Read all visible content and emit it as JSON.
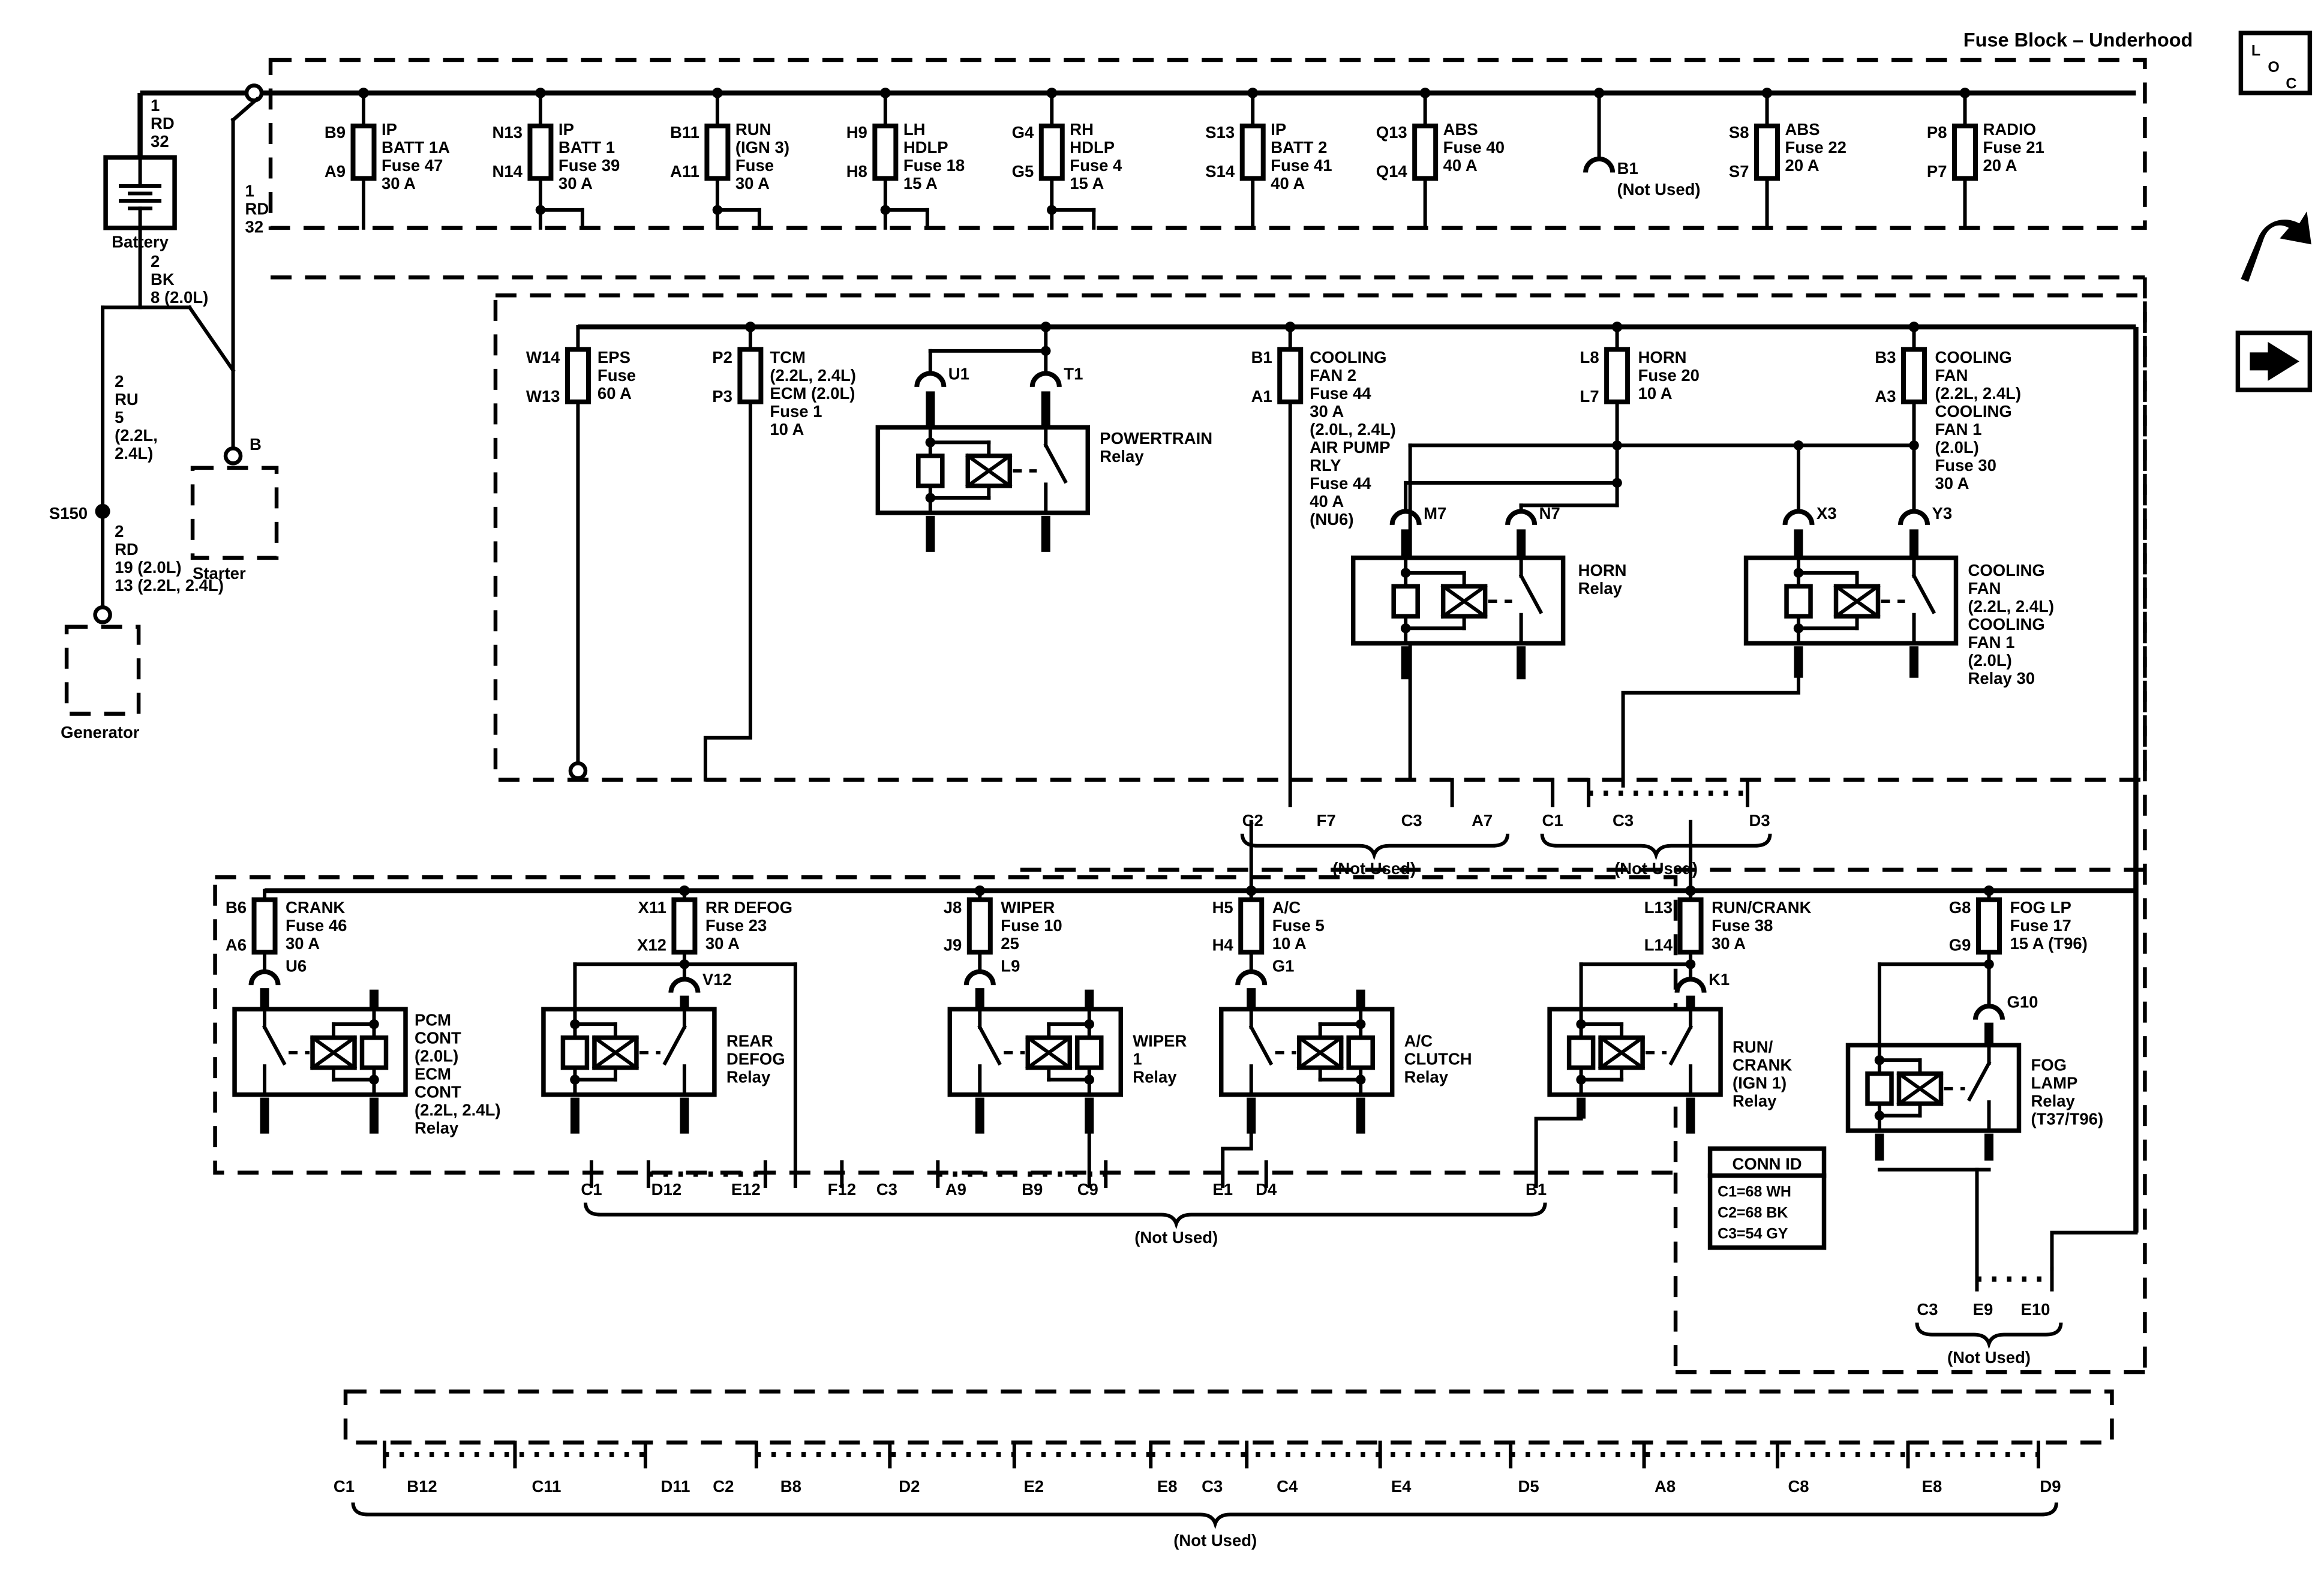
{
  "title": "Fuse Block – Underhood",
  "corner": {
    "loc": [
      "L",
      "O",
      "C"
    ]
  },
  "left": {
    "wire_battery_top": [
      "1",
      "RD",
      "32"
    ],
    "battery": "Battery",
    "wire_starter": [
      "1",
      "RD",
      "32"
    ],
    "terminal_b": "B",
    "starter": "Starter",
    "wire_battery_neg": [
      "2",
      "BK",
      "8 (2.0L)"
    ],
    "wire_ru": [
      "2",
      "RU",
      "5",
      "(2.2L,",
      "2.4L)"
    ],
    "splice": "S150",
    "wire_rd2": [
      "2",
      "RD",
      "19 (2.0L)",
      "13 (2.2L, 2.4L)"
    ],
    "generator": "Generator"
  },
  "row1": {
    "fuses": [
      {
        "pt": "B9",
        "pb": "A9",
        "d": [
          "IP",
          "BATT 1A",
          "Fuse 47",
          "30 A"
        ]
      },
      {
        "pt": "N13",
        "pb": "N14",
        "d": [
          "IP",
          "BATT 1",
          "Fuse 39",
          "30 A"
        ]
      },
      {
        "pt": "B11",
        "pb": "A11",
        "d": [
          "RUN",
          "(IGN 3)",
          "Fuse",
          "30 A"
        ]
      },
      {
        "pt": "H9",
        "pb": "H8",
        "d": [
          "LH",
          "HDLP",
          "Fuse 18",
          "15 A"
        ]
      },
      {
        "pt": "G4",
        "pb": "G5",
        "d": [
          "RH",
          "HDLP",
          "Fuse 4",
          "15 A"
        ]
      },
      {
        "pt": "S13",
        "pb": "S14",
        "d": [
          "IP",
          "BATT 2",
          "Fuse 41",
          "40 A"
        ]
      },
      {
        "pt": "Q13",
        "pb": "Q14",
        "d": [
          "ABS",
          "Fuse 40",
          "40 A"
        ]
      },
      {
        "pt": "S8",
        "pb": "S7",
        "d": [
          "ABS",
          "Fuse 22",
          "20 A"
        ]
      },
      {
        "pt": "P8",
        "pb": "P7",
        "d": [
          "RADIO",
          "Fuse 21",
          "20 A"
        ]
      }
    ],
    "stub": {
      "pin": "B1",
      "note": "(Not Used)"
    }
  },
  "row2": {
    "fuses": [
      {
        "pt": "W14",
        "pb": "W13",
        "d": [
          "EPS",
          "Fuse",
          "60 A"
        ]
      },
      {
        "pt": "P2",
        "pb": "P3",
        "d": [
          "TCM",
          "(2.2L, 2.4L)",
          "ECM (2.0L)",
          "Fuse 1",
          "10 A"
        ]
      },
      {
        "pt": "B1",
        "pb": "A1",
        "d": [
          "COOLING",
          "FAN 2",
          "Fuse 44",
          "30 A",
          "(2.0L, 2.4L)",
          "AIR PUMP",
          "RLY",
          "Fuse 44",
          "40 A",
          "(NU6)"
        ]
      },
      {
        "pt": "L8",
        "pb": "L7",
        "d": [
          "HORN",
          "Fuse 20",
          "10 A"
        ]
      },
      {
        "pt": "B3",
        "pb": "A3",
        "d": [
          "COOLING",
          "FAN",
          "(2.2L, 2.4L)",
          "COOLING",
          "FAN 1",
          "(2.0L)",
          "Fuse 30",
          "30 A"
        ]
      }
    ],
    "relays": [
      {
        "pa": "U1",
        "pb": "T1",
        "label": [
          "POWERTRAIN",
          "Relay"
        ]
      },
      {
        "pa": "M7",
        "pb": "N7",
        "label": [
          "HORN",
          "Relay"
        ]
      },
      {
        "pa": "X3",
        "pb": "Y3",
        "label": [
          "COOLING",
          "FAN",
          "(2.2L, 2.4L)",
          "COOLING",
          "FAN 1",
          "(2.0L)",
          "Relay 30"
        ]
      }
    ]
  },
  "row3": {
    "fuses": [
      {
        "pt": "B6",
        "pb": "A6",
        "d": [
          "CRANK",
          "Fuse 46",
          "30 A"
        ],
        "pin": "U6"
      },
      {
        "pt": "X11",
        "pb": "X12",
        "d": [
          "RR DEFOG",
          "Fuse 23",
          "30 A"
        ],
        "pin": "V12"
      },
      {
        "pt": "J8",
        "pb": "J9",
        "d": [
          "WIPER",
          "Fuse 10",
          "25"
        ],
        "pin": "L9"
      },
      {
        "pt": "H5",
        "pb": "H4",
        "d": [
          "A/C",
          "Fuse 5",
          "10 A"
        ],
        "pin": "G1"
      },
      {
        "pt": "L13",
        "pb": "L14",
        "d": [
          "RUN/CRANK",
          "Fuse 38",
          "30 A"
        ],
        "pin": "K1"
      },
      {
        "pt": "G8",
        "pb": "G9",
        "d": [
          "FOG LP",
          "Fuse 17",
          "15 A (T96)"
        ],
        "pin": "G10"
      }
    ],
    "relays": [
      {
        "label": [
          "PCM",
          "CONT",
          "(2.0L)",
          "ECM",
          "CONT",
          "(2.2L, 2.4L)",
          "Relay"
        ]
      },
      {
        "label": [
          "REAR",
          "DEFOG",
          "Relay"
        ]
      },
      {
        "label": [
          "WIPER",
          "1",
          "Relay"
        ]
      },
      {
        "label": [
          "A/C",
          "CLUTCH",
          "Relay"
        ]
      },
      {
        "label": [
          "RUN/",
          "CRANK",
          "(IGN 1)",
          "Relay"
        ]
      },
      {
        "label": [
          "FOG",
          "LAMP",
          "Relay",
          "(T37/T96)"
        ]
      }
    ]
  },
  "groups": [
    {
      "labels": [
        "C2",
        "F7",
        "C3",
        "A7"
      ],
      "note": "(Not Used)"
    },
    {
      "labels": [
        "C1",
        "C3",
        "D3"
      ],
      "note": "(Not Used)"
    },
    {
      "labels": [
        "C1",
        "D12",
        "E12",
        "F12",
        "C3",
        "A9",
        "B9",
        "C9",
        "E1",
        "D4",
        "B1"
      ],
      "note": "(Not Used)"
    },
    {
      "labels": [
        "C3",
        "E9",
        "E10"
      ],
      "note": "(Not Used)"
    },
    {
      "labels": [
        "C1",
        "B12",
        "C11",
        "D11",
        "C2",
        "B8",
        "D2",
        "E2",
        "E8",
        "C3",
        "C4",
        "E4",
        "D5",
        "A8",
        "C8",
        "E8",
        "D9"
      ],
      "note": "(Not Used)"
    }
  ],
  "conn_id": {
    "title": "CONN ID",
    "rows": [
      "C1=68 WH",
      "C2=68 BK",
      "C3=54 GY"
    ]
  }
}
